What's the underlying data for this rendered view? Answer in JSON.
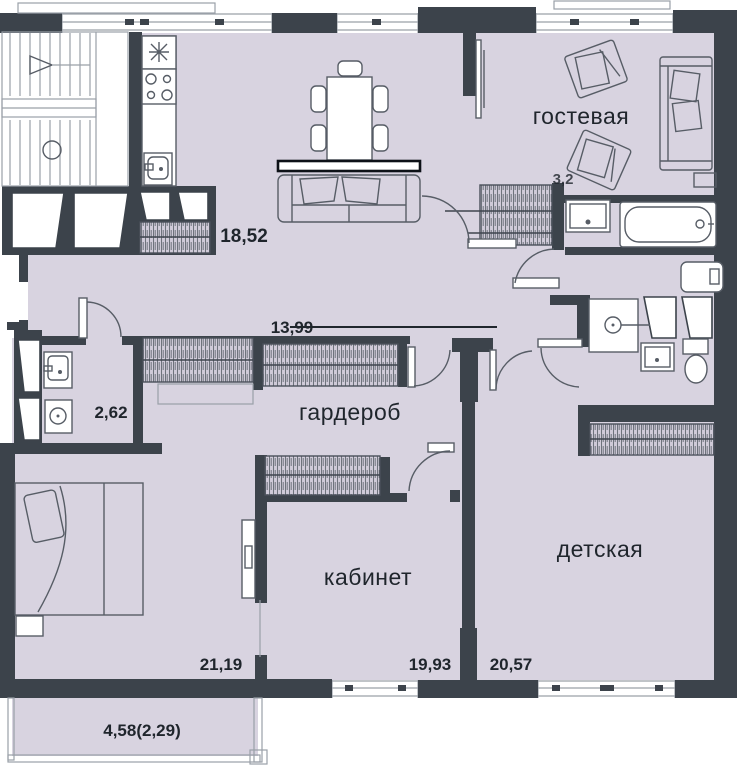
{
  "colors": {
    "wall": "#3c434b",
    "floor": "#d8d3e0",
    "line": "#575d66",
    "text": "#1f252c"
  },
  "rooms": {
    "living_kitchen": {
      "area": "18,52"
    },
    "guest": {
      "name": "гостевая"
    },
    "bathroom": {
      "area": "3,2"
    },
    "hallway": {
      "area": "13,99"
    },
    "laundry": {
      "area": "2,62"
    },
    "wardrobe": {
      "name": "гардероб"
    },
    "bedroom": {
      "area": "21,19"
    },
    "study": {
      "name": "кабинет",
      "area": "19,93"
    },
    "kids": {
      "name": "детская",
      "area": "20,57"
    },
    "balcony": {
      "area": "4,58(2,29)"
    }
  }
}
